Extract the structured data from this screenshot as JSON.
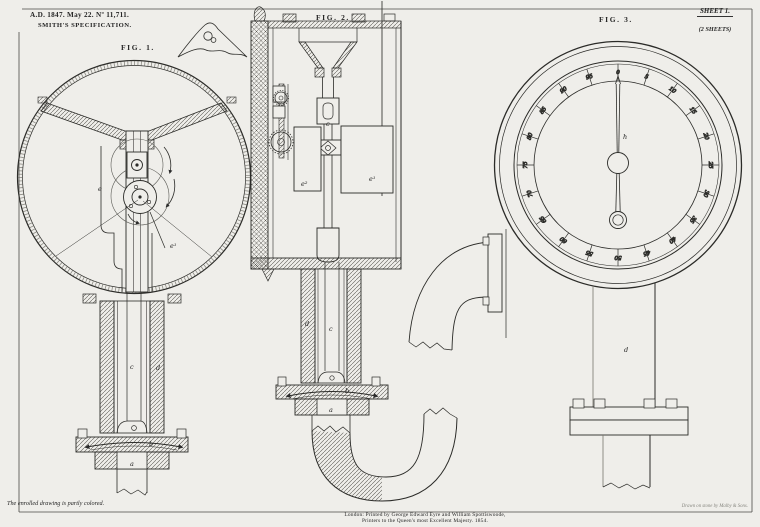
{
  "header": {
    "date_line": "A.D. 1847. May 22. Nº 11,711.",
    "title_line": "SMITH'S SPECIFICATION.",
    "sheet": {
      "label": "SHEET 1.",
      "count": "(2 SHEETS)"
    }
  },
  "figures": {
    "fig1": {
      "label": "FIG. 1.",
      "parts": {
        "e": "e",
        "e1": "e¹",
        "c": "c",
        "d": "d",
        "b": "b",
        "a": "a"
      }
    },
    "fig2": {
      "label": "FIG. 2.",
      "parts": {
        "e2": "e²",
        "e1": "e¹",
        "c": "c",
        "d": "d",
        "b": "b",
        "a": "a"
      }
    },
    "fig3": {
      "label": "FIG. 3.",
      "parts": {
        "h": "h",
        "d": "d"
      },
      "dial": {
        "values": [
          0,
          5,
          10,
          15,
          20,
          25,
          30,
          35,
          40,
          45,
          50,
          55,
          60,
          65,
          70,
          75,
          80,
          85,
          90,
          95
        ],
        "start_angle_deg": 0,
        "step_deg": 18,
        "needle_at": 0
      }
    }
  },
  "footer": {
    "note": "The enrolled drawing is partly colored.",
    "imprint_line1": "London: Printed by George Edward Eyre and William Spottiswoode,",
    "imprint_line2": "Printers to the Queen's most Excellent Majesty. 1854.",
    "credit": "Drawn on stone by Malby & Sons."
  },
  "colors": {
    "paper": "#efeeea",
    "ink": "#262626"
  }
}
